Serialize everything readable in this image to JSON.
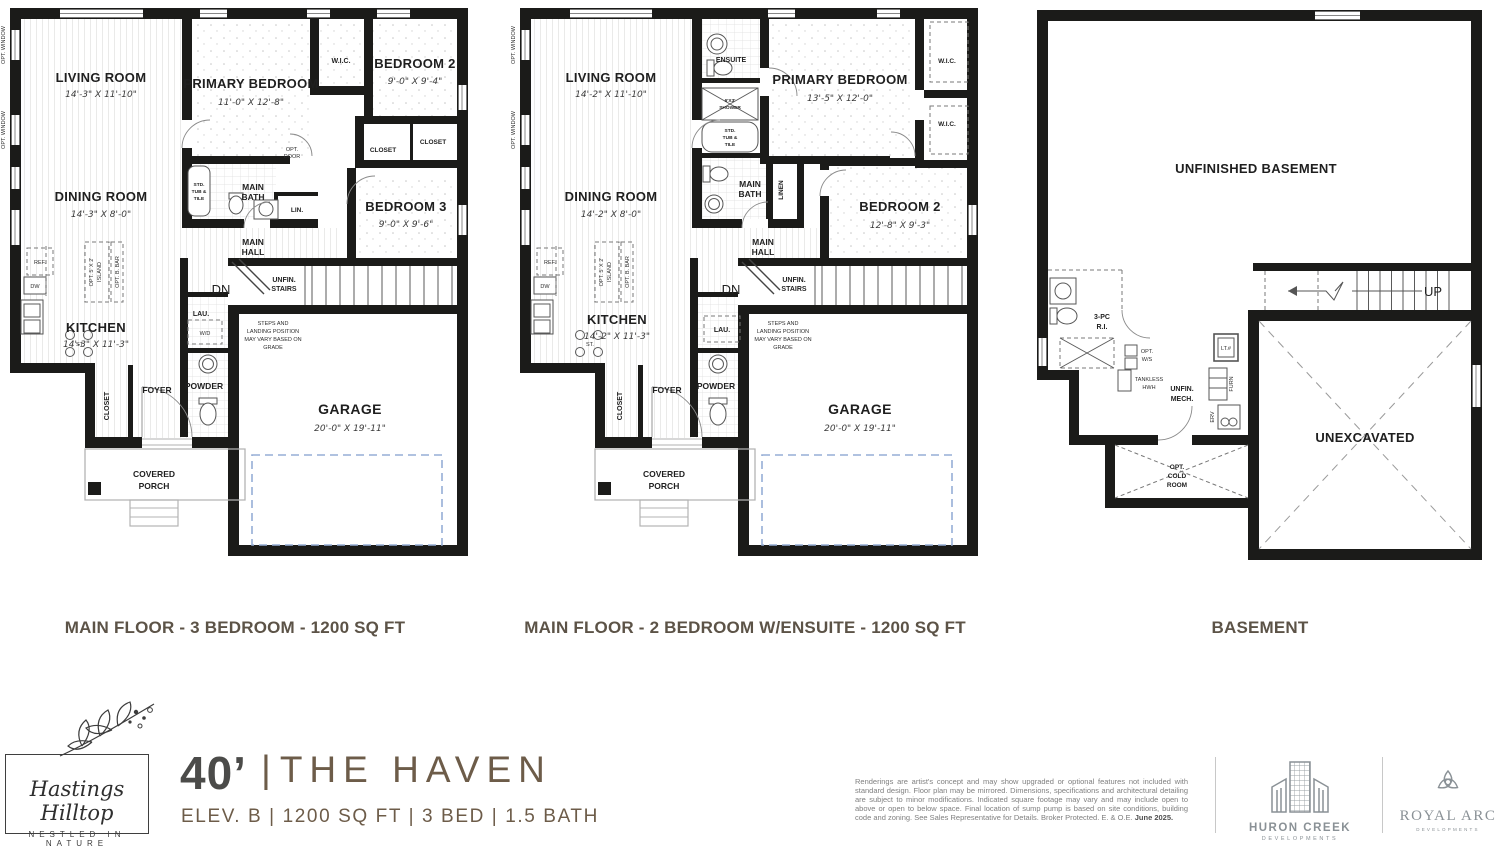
{
  "captions": {
    "plan1": "MAIN FLOOR - 3 BEDROOM - 1200 SQ FT",
    "plan2": "MAIN FLOOR - 2 BEDROOM W/ENSUITE - 1200 SQ FT",
    "basement": "BASEMENT"
  },
  "shared": {
    "opt_window": "OPT. WINDOW",
    "living_room": "LIVING ROOM",
    "dining_room": "DINING ROOM",
    "kitchen": "KITCHEN",
    "primary_bedroom": "PRIMARY BEDROOM",
    "bedroom2": "BEDROOM 2",
    "bedroom3": "BEDROOM 3",
    "garage": "GARAGE",
    "garage_dims": "20'-0\" X 19'-11\"",
    "wic": "W.I.C.",
    "closet": "CLOSET",
    "lin": "LIN.",
    "linen": "LINEN",
    "main_l": "MAIN",
    "bath_l": "BATH",
    "hall_l": "HALL",
    "unfin_l": "UNFIN.",
    "stairs_l": "STAIRS",
    "dn": "DN",
    "up": "UP",
    "lau": "LAU.",
    "wd": "W/D",
    "powder": "POWDER",
    "foyer": "FOYER",
    "ref": "REF.",
    "dw": "DW",
    "st": "ST.",
    "opt_island_l1": "OPT. 5' X 2'",
    "opt_island_l2": "ISLAND",
    "opt_bbar": "OPT. B. BAR",
    "std_l": "STD.",
    "tub_l": "TUB &",
    "tile_l": "TILE",
    "opt_l": "OPT.",
    "door_l": "DOOR",
    "steps_l1": "STEPS AND",
    "steps_l2": "LANDING POSITION",
    "steps_l3": "MAY VARY BASED ON",
    "steps_l4": "GRADE",
    "covered_l": "COVERED",
    "porch_l": "PORCH"
  },
  "plan1": {
    "living_dims": "14'-3\" X 11'-10\"",
    "dining_dims": "14'-3\" X 8'-0\"",
    "kitchen_dims": "14'-3\" X 11'-3\"",
    "primary_dims": "11'-0\" X 12'-8\"",
    "bedroom2_dims": "9'-0\" X 9'-4\"",
    "bedroom3_dims": "9'-0\" X 9'-6\""
  },
  "plan2": {
    "living_dims": "14'-2\" X 11'-10\"",
    "dining_dims": "14'-2\" X 8'-0\"",
    "kitchen_dims": "14'-2\" X 11'-3\"",
    "primary_dims": "13'-5\" X 12'-0\"",
    "bedroom2_dims": "12'-8\" X 9'-3\"",
    "ensuite": "ENSUITE",
    "shower_l1": "6'X3'",
    "shower_l2": "SHOWER"
  },
  "basement": {
    "unfinished": "UNFINISHED BASEMENT",
    "unexcavated": "UNEXCAVATED",
    "rough_in_l1": "3-PC",
    "rough_in_l2": "R.I.",
    "opt_ws_l1": "OPT.",
    "opt_ws_l2": "W/S",
    "tankless_l1": "TANKLESS",
    "tankless_l2": "HWH",
    "mech_l1": "UNFIN.",
    "mech_l2": "MECH.",
    "lt": "LT.#",
    "furn": "FURN",
    "erv": "ERV",
    "cold_l1": "OPT.",
    "cold_l2": "COLD",
    "cold_l3": "ROOM"
  },
  "footer": {
    "community_name": "Hastings Hilltop",
    "community_tagline": "NESTLED IN NATURE",
    "frontage": "40’",
    "divider": "|",
    "plan_name": "THE HAVEN",
    "subtitle": "ELEV. B | 1200 SQ FT | 3 BED | 1.5 BATH",
    "disclaimer": "Renderings are artist's concept and may show upgraded or optional features not included with standard design. Floor plan may be mirrored. Dimensions, specifications and architectural detailing are subject to minor modifications. Indicated square footage may vary and may include open to above or open to below space. Final location of sump pump is based on site conditions, building code and zoning. See Sales Representative for Details. Broker Protected. E. & O.E. ",
    "disclaimer_date": "June 2025.",
    "dev1_name": "HURON CREEK",
    "dev1_sub": "DEVELOPMENTS",
    "dev2_name": "ROYAL ARC",
    "dev2_sub": "DEVELOPMENTS"
  },
  "colors": {
    "wall": "#1b1b19",
    "caption": "#5c5347",
    "title_gray": "#4b4b49",
    "brand_brown": "#6d5c49",
    "disclaimer_gray": "#7f7f7f",
    "logo_gray": "#8a9196",
    "garage_door_blue": "#96aed6"
  }
}
